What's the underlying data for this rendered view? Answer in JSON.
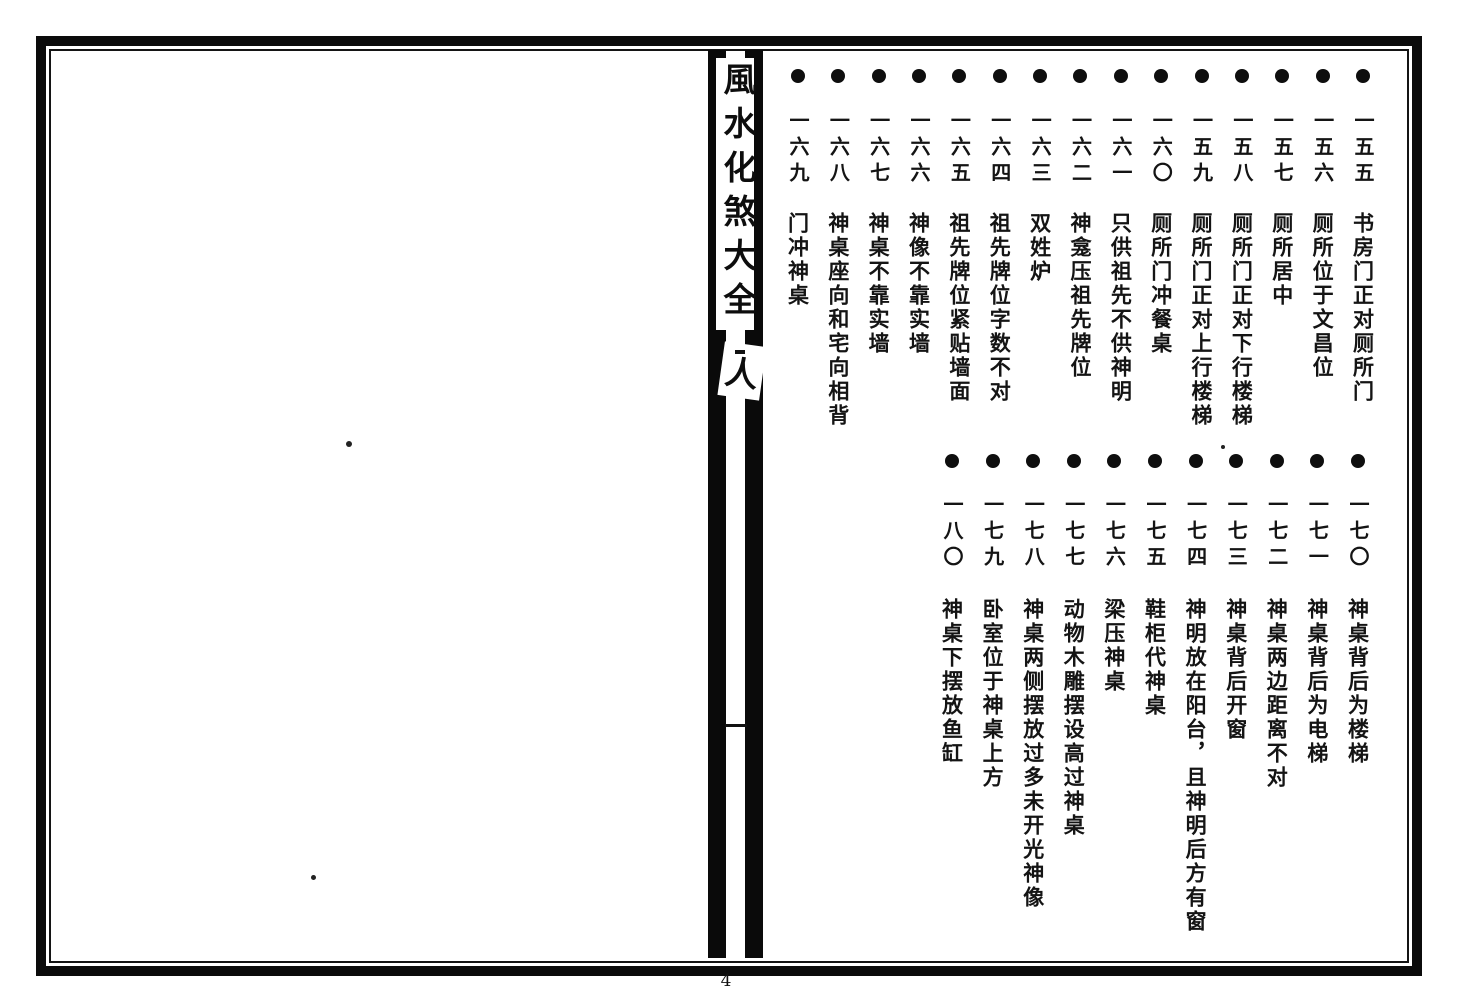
{
  "book": {
    "spine_title": "風水化煞大全",
    "spine_mark": "人",
    "page_number": "4"
  },
  "toc": {
    "top_row": [
      {
        "num": "一五五",
        "title": "书房门正对厕所门"
      },
      {
        "num": "一五六",
        "title": "厕所位于文昌位"
      },
      {
        "num": "一五七",
        "title": "厕所居中"
      },
      {
        "num": "一五八",
        "title": "厕所门正对下行楼梯"
      },
      {
        "num": "一五九",
        "title": "厕所门正对上行楼梯"
      },
      {
        "num": "一六〇",
        "title": "厕所门冲餐桌"
      },
      {
        "num": "一六一",
        "title": "只供祖先不供神明"
      },
      {
        "num": "一六二",
        "title": "神龛压祖先牌位"
      },
      {
        "num": "一六三",
        "title": "双姓炉"
      },
      {
        "num": "一六四",
        "title": "祖先牌位字数不对"
      },
      {
        "num": "一六五",
        "title": "祖先牌位紧贴墙面"
      },
      {
        "num": "一六六",
        "title": "神像不靠实墙"
      },
      {
        "num": "一六七",
        "title": "神桌不靠实墙"
      },
      {
        "num": "一六八",
        "title": "神桌座向和宅向相背"
      },
      {
        "num": "一六九",
        "title": "门冲神桌"
      }
    ],
    "bottom_row": [
      {
        "num": "一七〇",
        "title": "神桌背后为楼梯"
      },
      {
        "num": "一七一",
        "title": "神桌背后为电梯"
      },
      {
        "num": "一七二",
        "title": "神桌两边距离不对"
      },
      {
        "num": "一七三",
        "title": "神桌背后开窗"
      },
      {
        "num": "一七四",
        "title": "神明放在阳台，且神明后方有窗"
      },
      {
        "num": "一七五",
        "title": "鞋柜代神桌"
      },
      {
        "num": "一七六",
        "title": "梁压神桌"
      },
      {
        "num": "一七七",
        "title": "动物木雕摆设高过神桌"
      },
      {
        "num": "一七八",
        "title": "神桌两侧摆放过多未开光神像"
      },
      {
        "num": "一七九",
        "title": "卧室位于神桌上方"
      },
      {
        "num": "一八〇",
        "title": "神桌下摆放鱼缸"
      }
    ]
  },
  "colors": {
    "ink": "#111111",
    "paper": "#ffffff"
  }
}
